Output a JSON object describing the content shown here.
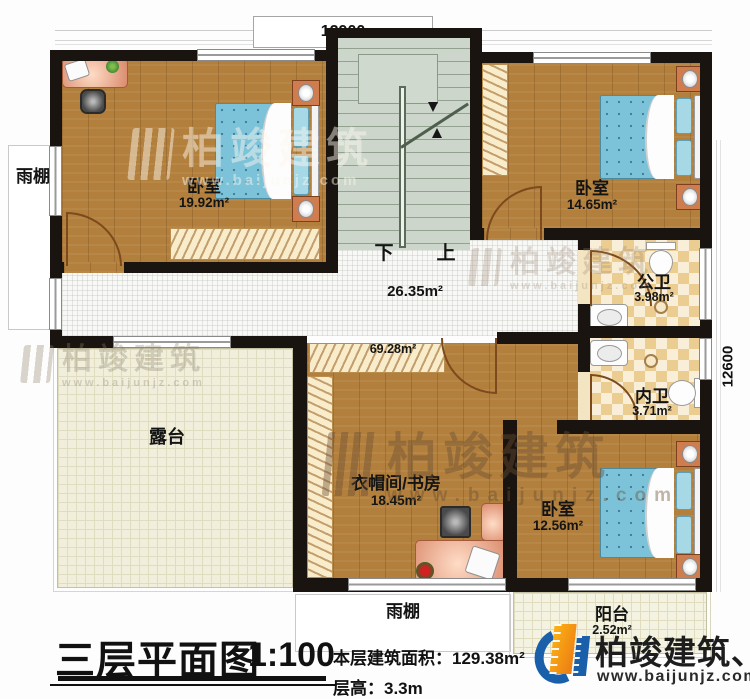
{
  "dimensions": {
    "top": "12900",
    "right": "12600"
  },
  "plan": {
    "bedroom_nw": {
      "name": "卧室",
      "area": "19.92m²"
    },
    "bedroom_ne": {
      "name": "卧室",
      "area": "14.65m²"
    },
    "bedroom_se": {
      "name": "卧室",
      "area": "12.56m²"
    },
    "public_bath": {
      "name": "公卫",
      "area": "3.98m²"
    },
    "private_bath": {
      "name": "内卫",
      "area": "3.71m²"
    },
    "cloak_study": {
      "name": "衣帽间/书房",
      "area": "18.45m²"
    },
    "hall_area": "26.35m²",
    "upper_area": "69.28m²",
    "terrace": "露台",
    "balcony": {
      "name": "阳台",
      "area": "2.52m²"
    },
    "canopy_left": "雨棚",
    "canopy_bottom": "雨棚",
    "stair_down": "下",
    "stair_up": "上"
  },
  "watermark": {
    "brand": "柏竣建筑",
    "url": "www.baijunjz.com"
  },
  "logo": {
    "brand": "柏竣建筑、",
    "url": "www.baijunjz.com"
  },
  "title_block": {
    "title": "三层平面图",
    "scale": "1:100",
    "floor_area_line": "本层建筑面积：129.38m²",
    "floor_height_line": "层高：3.3m"
  },
  "colors": {
    "wall": "#19140f",
    "wood": "#b2803c",
    "logo_orange": "#f5991d",
    "logo_blue": "#1a5fa9"
  }
}
